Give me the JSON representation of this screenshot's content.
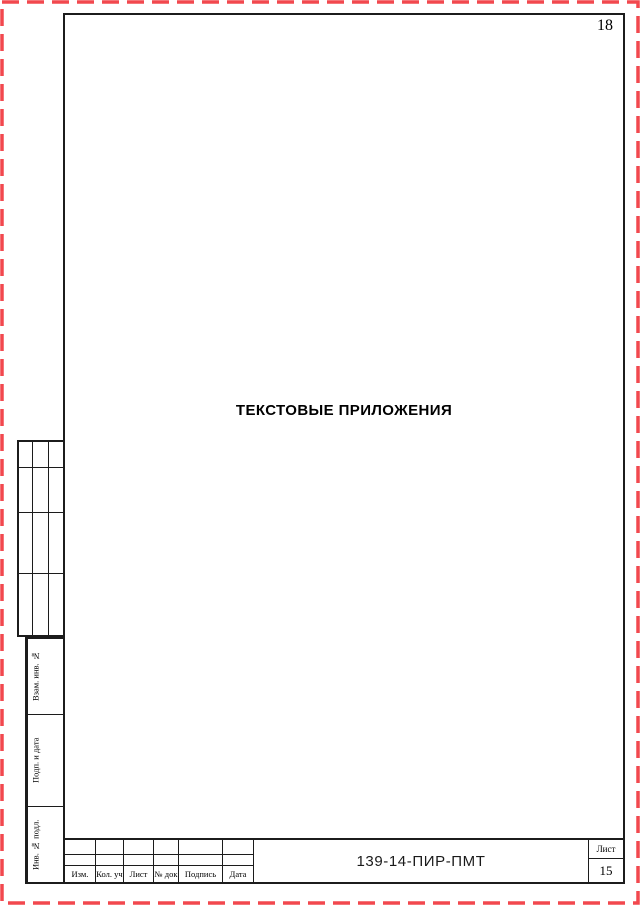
{
  "page": {
    "number": "18",
    "title": "ТЕКСТОВЫЕ ПРИЛОЖЕНИЯ"
  },
  "colors": {
    "border_dash": "#f2484e",
    "frame_line": "#1c1c1c",
    "text": "#000000"
  },
  "side_panel": {
    "labels": [
      "Взам. инв. №",
      "Подп. и дата",
      "Инв. № подл."
    ]
  },
  "title_block": {
    "doc_number": "139-14-ПИР-ПМТ",
    "columns": [
      "Изм.",
      "Кол. уч",
      "Лист",
      "№ док",
      "Подпись",
      "Дата"
    ],
    "sheet_label": "Лист",
    "sheet_number": "15"
  }
}
